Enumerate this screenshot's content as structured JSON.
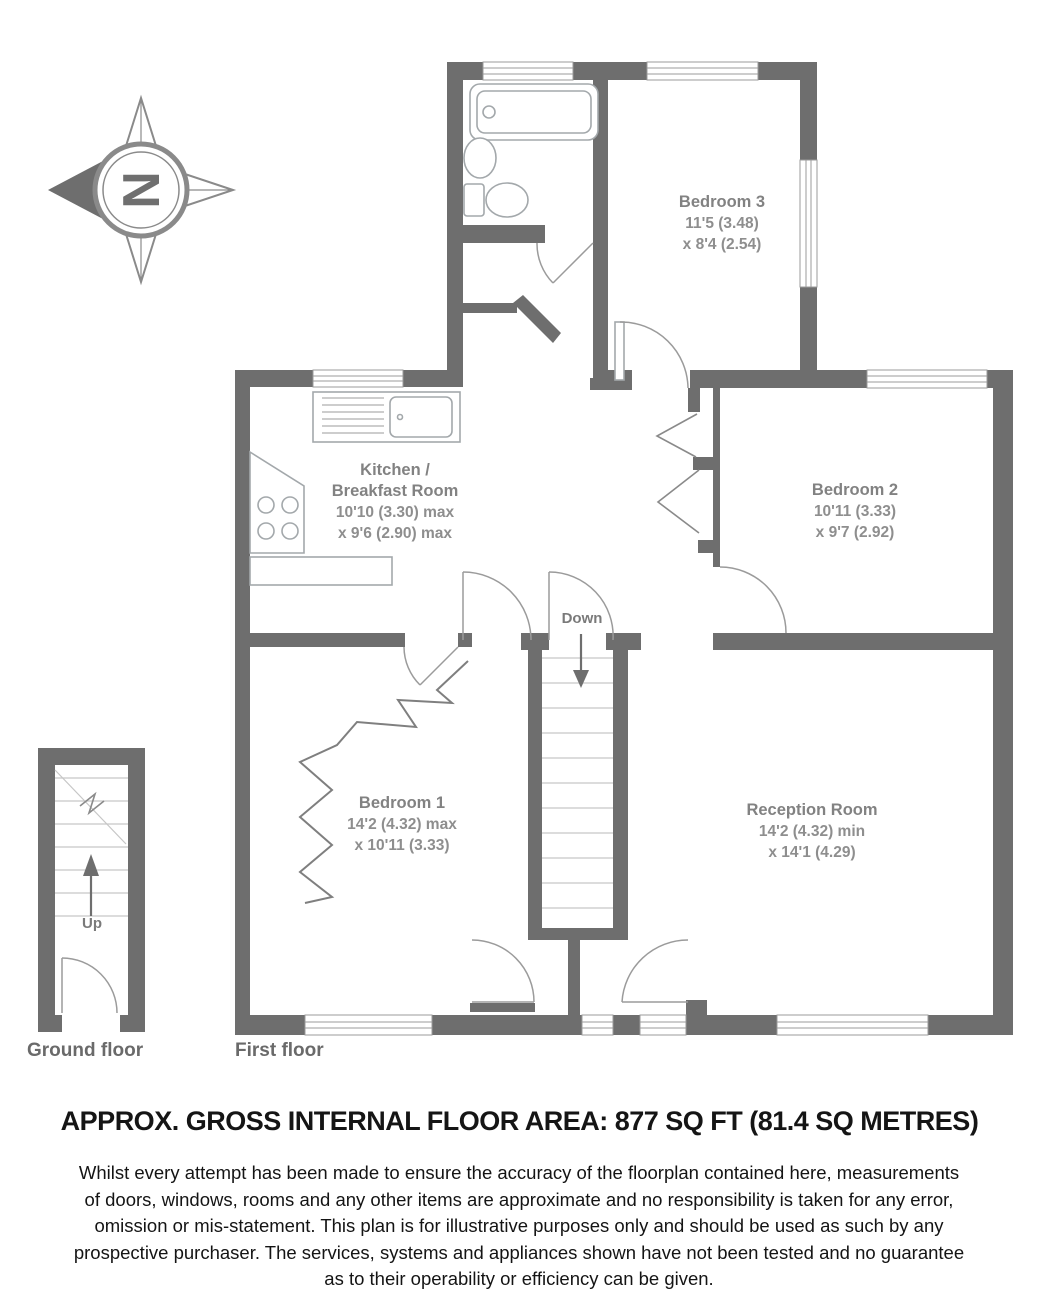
{
  "compass": {
    "north_label": "N"
  },
  "floors": {
    "ground": {
      "label": "Ground floor",
      "stairs_label": "Up"
    },
    "first": {
      "label": "First floor",
      "stairs_label": "Down"
    }
  },
  "rooms": {
    "bedroom3": {
      "name": "Bedroom 3",
      "dim1": "11'5 (3.48)",
      "dim2": "x 8'4 (2.54)"
    },
    "bedroom2": {
      "name": "Bedroom 2",
      "dim1": "10'11 (3.33)",
      "dim2": "x 9'7 (2.92)"
    },
    "kitchen": {
      "name": "Kitchen /\nBreakfast Room",
      "dim1": "10'10 (3.30) max",
      "dim2": "x 9'6 (2.90) max"
    },
    "bedroom1": {
      "name": "Bedroom 1",
      "dim1": "14'2 (4.32) max",
      "dim2": "x 10'11 (3.33)"
    },
    "reception": {
      "name": "Reception Room",
      "dim1": "14'2 (4.32) min",
      "dim2": "x 14'1 (4.29)"
    }
  },
  "footer": {
    "area_title": "APPROX. GROSS INTERNAL FLOOR AREA: 877 SQ FT (81.4 SQ METRES)",
    "disclaimer": "Whilst every attempt has been made to ensure the accuracy of the floorplan contained here, measurements\nof doors, windows, rooms and any other items are approximate and no responsibility is taken for any error,\nomission or mis-statement. This plan is for illustrative purposes only and should be used as such by any\nprospective purchaser. The services, systems and appliances shown have not been tested and no guarantee\nas to their operability or efficiency can be given."
  },
  "colors": {
    "wall": "#6e6e6e",
    "thin_line": "#9b9b9b",
    "label_gray": "#8e8e8e",
    "title": "#151515"
  }
}
